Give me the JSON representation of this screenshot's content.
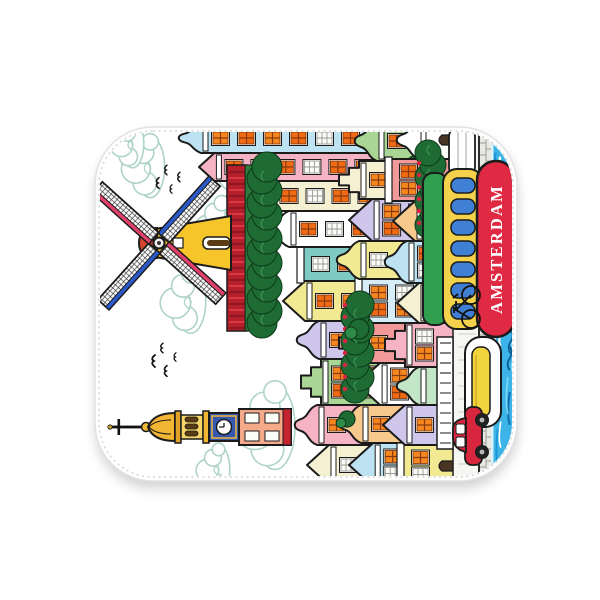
{
  "banner_text": "AMSTERDAM",
  "palette": {
    "outline": "#1b1b1b",
    "blanket": "#ffffff",
    "blanket_border": "#e2e2e2",
    "stitch": "#d6d6d6",
    "cloud_stroke": "#aed3c8",
    "window_orange": "#f6871f",
    "window_orange_dark": "#ef6a12",
    "tulip_red": "#b51f2c",
    "hedge_green": "#1e6b34",
    "water_blue": "#3cb4e7"
  },
  "blanket": {
    "x": 95,
    "y": 127,
    "w": 422,
    "h": 354,
    "radius": 58
  },
  "scene": {
    "clouds": [
      [
        308,
        148,
        1.15
      ],
      [
        252,
        118,
        0.85
      ],
      [
        178,
        86,
        0.95
      ],
      [
        52,
        168,
        1.25
      ],
      [
        312,
        46,
        0.9
      ],
      [
        335,
        30,
        0.7
      ],
      [
        10,
        116,
        0.7
      ]
    ],
    "birds": [
      [
        118,
        58,
        1.0
      ],
      [
        131,
        66,
        0.8
      ],
      [
        108,
        70,
        0.9
      ],
      [
        122,
        79,
        0.7
      ],
      [
        296,
        62,
        0.9
      ],
      [
        309,
        70,
        0.8
      ],
      [
        290,
        75,
        0.7
      ],
      [
        302,
        83,
        0.8
      ]
    ],
    "tower": {
      "cx": 52
    },
    "windmill": {
      "hubX": 236,
      "hubY": 62,
      "armLen": 76,
      "armW": 15,
      "armAngles": [
        42,
        132,
        222,
        312
      ],
      "bodyColor": "#f5c52a",
      "capColor": "#d8452e",
      "edgeBlue": "#2b59c8",
      "edgePink": "#e0406a"
    },
    "tulipField": {
      "x": 148,
      "y": 130,
      "w": 166,
      "h": 26
    },
    "hedges": [
      [
        150,
        156,
        165,
        22
      ],
      [
        84,
        250,
        96,
        20
      ],
      [
        248,
        324,
        82,
        18
      ]
    ],
    "trees": [
      [
        150,
        262,
        10
      ],
      [
        226,
        318,
        9
      ],
      [
        92,
        320,
        8
      ],
      [
        314,
        318,
        9
      ],
      [
        60,
        250,
        8
      ]
    ],
    "houseRows": [
      {
        "name": "back",
        "baseline": 358,
        "houses": [
          {
            "x": -6,
            "w": 40,
            "top": 210,
            "c": "#f6f0d2",
            "g": "point"
          },
          {
            "x": 34,
            "w": 40,
            "top": 196,
            "c": "#f6b3c3",
            "g": "bell"
          },
          {
            "x": 74,
            "w": 46,
            "top": 204,
            "c": "#a9d694",
            "g": "step"
          },
          {
            "x": 120,
            "w": 38,
            "top": 198,
            "c": "#cfc6ec",
            "g": "bell"
          },
          {
            "x": 158,
            "w": 40,
            "top": 186,
            "c": "#f2ea93",
            "g": "point"
          },
          {
            "x": 198,
            "w": 34,
            "top": 196,
            "c": "#7fcbc4",
            "g": "flat"
          },
          {
            "x": 232,
            "w": 36,
            "top": 168,
            "c": "#ffffff",
            "g": "bell"
          },
          {
            "x": 268,
            "w": 30,
            "top": 130,
            "c": "#f6f0d2",
            "g": "point"
          },
          {
            "x": 298,
            "w": 28,
            "top": 102,
            "c": "#f6b3c3",
            "g": "point"
          },
          {
            "x": 326,
            "w": 30,
            "top": 80,
            "c": "#bde2f2",
            "g": "bell"
          }
        ]
      },
      {
        "name": "middle",
        "baseline": 358,
        "houses": [
          {
            "x": -8,
            "w": 44,
            "top": 252,
            "c": "#bde2f2",
            "g": "point"
          },
          {
            "x": 36,
            "w": 38,
            "top": 240,
            "c": "#f8c98d",
            "g": "bell"
          },
          {
            "x": 74,
            "w": 42,
            "top": 260,
            "c": "#ffffff",
            "g": "point"
          },
          {
            "x": 116,
            "w": 40,
            "top": 242,
            "c": "#f29a9a",
            "g": "step"
          },
          {
            "x": 156,
            "w": 44,
            "top": 254,
            "c": "#d6ecf7",
            "g": "flat"
          },
          {
            "x": 200,
            "w": 38,
            "top": 238,
            "c": "#f2ea93",
            "g": "bell"
          },
          {
            "x": 238,
            "w": 42,
            "top": 252,
            "c": "#cfc6ec",
            "g": "point"
          },
          {
            "x": 280,
            "w": 38,
            "top": 242,
            "c": "#f6f0d2",
            "g": "step"
          },
          {
            "x": 318,
            "w": 40,
            "top": 256,
            "c": "#a9d694",
            "g": "bell"
          }
        ]
      },
      {
        "name": "front",
        "baseline": 358,
        "houses": [
          {
            "x": -8,
            "w": 42,
            "top": 296,
            "c": "#f2ea93",
            "g": "flat",
            "door": true
          },
          {
            "x": 34,
            "w": 40,
            "top": 286,
            "c": "#cfc6ec",
            "g": "point"
          },
          {
            "x": 74,
            "w": 38,
            "top": 298,
            "c": "#c3e6c6",
            "g": "bell",
            "door": true
          },
          {
            "x": 112,
            "w": 44,
            "top": 288,
            "c": "#f6b3c3",
            "g": "step"
          },
          {
            "x": 156,
            "w": 40,
            "top": 300,
            "c": "#f6f0d2",
            "g": "point",
            "door": true
          },
          {
            "x": 196,
            "w": 42,
            "top": 286,
            "c": "#bde2f2",
            "g": "bell"
          },
          {
            "x": 238,
            "w": 40,
            "top": 296,
            "c": "#f8c98d",
            "g": "point",
            "door": true
          },
          {
            "x": 278,
            "w": 42,
            "top": 284,
            "c": "#f29a9a",
            "g": "flat"
          },
          {
            "x": 320,
            "w": 38,
            "top": 298,
            "c": "#ffffff",
            "g": "bell",
            "door": true
          }
        ]
      }
    ],
    "quay": {
      "streetY": 356,
      "streetH": 26,
      "wallY": 382,
      "wallH": 14,
      "railing": {
        "x": 30,
        "y": 340,
        "w": 112,
        "h": 16
      }
    },
    "water": {
      "y": 394,
      "h": 30,
      "base": "#3cb4e7",
      "streaks": [
        "#1b94d6",
        "#7fd9f5",
        "#ffffff",
        "#146fae",
        "#0d5e96"
      ]
    },
    "tourBoat": {
      "roof": {
        "x": 154,
        "y": 326,
        "w": 152,
        "h": 24,
        "c": "#2f9e4f"
      },
      "band": {
        "x": 150,
        "y": 346,
        "w": 160,
        "h": 40,
        "c": "#f5d24b"
      },
      "hull": {
        "x": 142,
        "y": 380,
        "w": 176,
        "h": 38,
        "c": "#e02a44"
      },
      "windowColor": "#3f7fd4",
      "windows": 7,
      "text": "AMSTERDAM"
    },
    "smallBoat": {
      "x": 52,
      "y": 368,
      "w": 90,
      "h": 36,
      "canopy": "#f2d43c"
    },
    "rowBoat": {
      "x": 300,
      "y": 352,
      "w": 54,
      "h": 26
    },
    "car": {
      "x": 14,
      "y": 356,
      "color": "#d7263d"
    },
    "bicycle": {
      "x": 152,
      "y": 352
    }
  }
}
